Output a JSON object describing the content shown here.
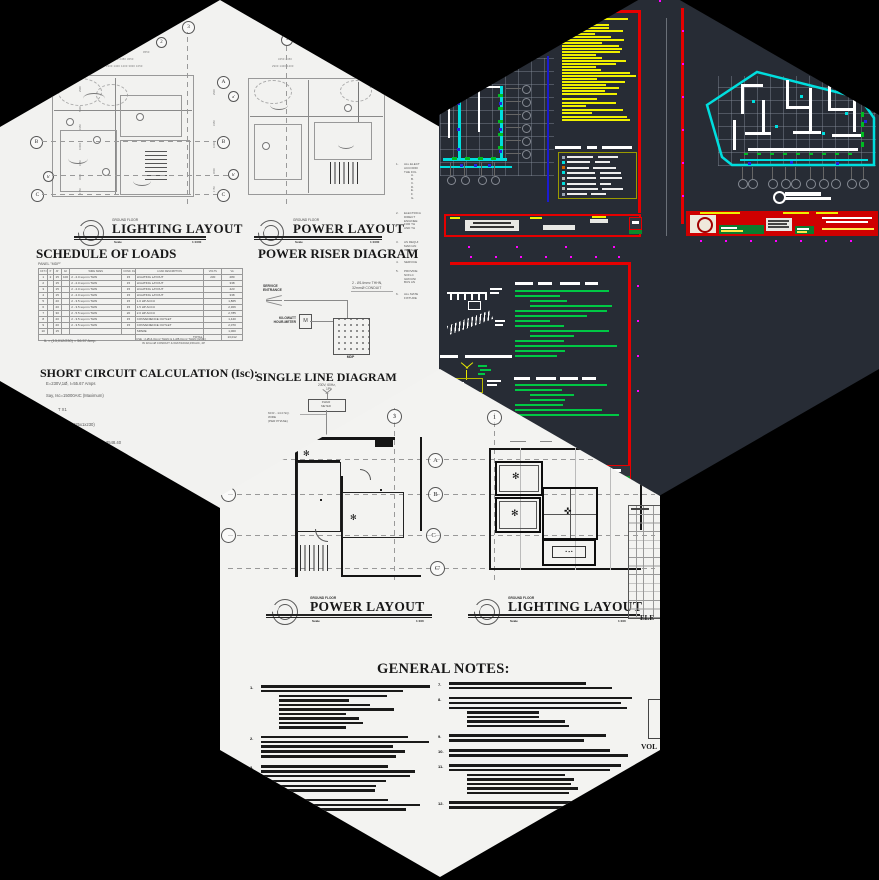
{
  "collage": {
    "background": "#000000",
    "tiles": "three hexagonal CAD-drawing thumbnails"
  },
  "hexagons": {
    "top_left": {
      "sheet_bg": "#f2f2f0",
      "plan_titles": [
        {
          "floor": "GROUND FLOOR",
          "title": "LIGHTING LAYOUT",
          "scale_label": "Scale",
          "scale": "1:1000"
        },
        {
          "floor": "GROUND FLOOR",
          "title": "POWER LAYOUT",
          "scale_label": "Scale",
          "scale": "1:1000"
        }
      ],
      "grid_bubbles": {
        "top": [
          "3",
          "2",
          "1"
        ],
        "center": [
          "A",
          "a'",
          "B",
          "b'",
          "C"
        ],
        "left": [
          "B",
          "b'",
          "C"
        ]
      },
      "dimensions_top_left_plan": {
        "row1": "9550",
        "row2": "3450   2450   3650",
        "row3": "2900  1400 1200  3000  1050"
      },
      "dimensions_top_right_plan": {
        "row2": "3450   2450",
        "row3": "2900  1400 1200"
      },
      "dimensions_side": [
        "2900",
        "5100",
        "3150",
        "10000",
        "3150",
        "4500",
        "1750"
      ],
      "schedule_of_loads": {
        "heading": "SCHEDULE OF LOADS",
        "panel_label": "PANEL  \"MDP\"",
        "columns": [
          "CKT NO.",
          "P",
          "AT",
          "AF",
          "WIRE SIZES",
          "COND. DIA.",
          "LOAD DESCRIPTION",
          "VOLTS",
          "VA"
        ],
        "rows": [
          [
            "1",
            "2",
            "15",
            "100",
            "2 - 2.0 sq.mm THW",
            "15",
            "LIGHTING LAYOUT",
            "230",
            "280"
          ],
          [
            "2",
            "",
            "15",
            "",
            "2 - 2.0 sq.mm THW",
            "15",
            "LIGHTING LAYOUT",
            "",
            "338"
          ],
          [
            "3",
            "",
            "15",
            "",
            "2 - 2.0 sq.mm THW",
            "15",
            "LIGHTING LAYOUT",
            "",
            "423"
          ],
          [
            "4",
            "",
            "15",
            "",
            "2 - 2.0 sq.mm THW",
            "15",
            "LIGHTING LAYOUT",
            "",
            "338"
          ],
          [
            "5",
            "",
            "20",
            "",
            "2 - 3.5 sq.mm THW",
            "15",
            "1.0 HP ACCU",
            "",
            "1,865"
          ],
          [
            "6",
            "",
            "20",
            "",
            "2 - 3.5 sq.mm THW",
            "15",
            "1.5 HP ACCU",
            "",
            "2,306"
          ],
          [
            "7",
            "",
            "30",
            "",
            "2 - 5.5 sq.mm THW",
            "20",
            "2.0 HP ACCU",
            "",
            "2,785"
          ],
          [
            "8",
            "",
            "20",
            "",
            "2 - 3.5 sq.mm THW",
            "15",
            "CONVENIENCE OUTLET",
            "",
            "1,440"
          ],
          [
            "9",
            "",
            "20",
            "",
            "2 - 3.5 sq.mm THW",
            "15",
            "CONVENIENCE OUTLET",
            "",
            "2,070"
          ],
          [
            "10",
            "",
            "15",
            "",
            "",
            "",
            "SPARE",
            "",
            "1,000"
          ]
        ],
        "total_label": "TOTAL",
        "total_value": "13,012",
        "footer_left": "IL  =  (13,012/230)  =  56.57  Amp.",
        "footer_right_1": "USE :   2-Ø14.0mm² THHN  &  1-Ø8.0mm² THHN (GND.)",
        "footer_right_2": "IN 32mmØ CONDUIT & 60AT/100AF,15KAIC, 2P"
      },
      "power_riser": {
        "heading": "POWER RISER DIAGRAM",
        "service_entrance": "SERVICE ENTRANCE",
        "feeder_line1": "2 - Ø14mm²  THHN,",
        "feeder_line2": "32mmØ CONDUIT",
        "meter_label1": "KILOWATT",
        "meter_label2": "HOUR-METER",
        "meter_symbol": "M",
        "panel_label": "MDP"
      },
      "short_circuit": {
        "heading": "SHORT CIRCUIT CALCULATION (Isc):",
        "line1": "E=230V,1Ø,  I=55.67  Amps",
        "line2": "Say, Isc=15000AIC  (Maximum)",
        "line3": "T  X1",
        "line4": "/(2425x1x230)",
        "line5": "0.23656  = 3548.40",
        "line6": "SYMMETRICAL"
      },
      "single_line": {
        "heading": "SINGLE LINE DIAGRAM",
        "service1": "230V, 60Hz,",
        "service2": "1Ph",
        "kwhr1": "KWHR",
        "kwhr2": "METER",
        "feeder_note1": "60 R - 14.0 SQ.",
        "feeder_note2": "WIRE",
        "feeder_note3": "(PER PHASE)"
      },
      "side_notes": [
        {
          "num": "1.",
          "lines": [
            "ALL ELECT",
            "ACCORDI",
            "THE FOL"
          ],
          "sub": [
            "A.",
            "B.",
            "C.",
            "D.",
            "E.",
            "F.",
            "G."
          ]
        },
        {
          "num": "2.",
          "lines": [
            "ELECTRICA",
            "DIRECT",
            "ENGINEE",
            "FOR TH",
            "AND TH"
          ],
          "sub": []
        },
        {
          "num": "3.",
          "lines": [
            "AS REQUI",
            "MAIN AN",
            "INSTALL"
          ],
          "sub": []
        },
        {
          "num": "4.",
          "lines": [
            "SERVICE"
          ],
          "sub": []
        },
        {
          "num": "5.",
          "lines": [
            "PROVIDE",
            "NON-C",
            "GROUNI",
            "BUS AN"
          ],
          "sub": []
        },
        {
          "num": "6.",
          "lines": [
            "ALL MATE",
            "FIXTURE"
          ],
          "sub": []
        }
      ]
    },
    "top_right": {
      "workspace_bg": "#272c35",
      "palette": {
        "sheet_border_red": "#e60000",
        "cad_text_yellow": "#f0f000",
        "highlight_cyan": "#00dede",
        "notes_green": "#00c844",
        "grip_magenta": "#ff00ff",
        "dash_green": "#00bb22",
        "point_blue": "#2525dd",
        "legend_border_olive": "#9a9a00",
        "stamp_green": "#0a8a2a",
        "titleblock_red": "#cf0000"
      },
      "legend_symbol_colors": [
        "#9aa7b5",
        "#00dede",
        "#cc6600",
        "#00dede",
        "#bbbbbb",
        "#00dede",
        "#bbbbbb",
        "#9aa7b5"
      ]
    },
    "bottom": {
      "sheet_bg": "#f3f3f1",
      "plan_titles": [
        {
          "floor": "GROUND FLOOR",
          "title": "POWER LAYOUT",
          "scale_label": "Scale",
          "scale": "1:100"
        },
        {
          "floor": "GROUND FLOOR",
          "title": "LIGHTING LAYOUT",
          "scale_label": "Scale",
          "scale": "1:100"
        }
      ],
      "grid_bubbles": {
        "top": [
          "3",
          "1"
        ],
        "center": [
          "A",
          "B",
          "C",
          "C'"
        ]
      },
      "general_notes_heading": "GENERAL NOTES:",
      "notes_left": [
        {
          "num": "1.",
          "lines": 2,
          "sub": 8
        },
        {
          "num": "2.",
          "lines": 5,
          "sub": 0
        },
        {
          "num": "3.",
          "lines": 4,
          "sub": 2
        },
        {
          "num": "4.",
          "lines": 3,
          "sub": 0
        }
      ],
      "notes_right": [
        {
          "num": "7.",
          "lines": 2,
          "sub": 0
        },
        {
          "num": "8.",
          "lines": 3,
          "sub": 4
        },
        {
          "num": "9.",
          "lines": 2,
          "sub": 0
        },
        {
          "num": "10.",
          "lines": 2,
          "sub": 0
        },
        {
          "num": "11.",
          "lines": 2,
          "sub": 5
        },
        {
          "num": "12.",
          "lines": 2,
          "sub": 0
        }
      ],
      "legend_partial_label": "ELE",
      "voltage_partial_label": "VOL"
    }
  }
}
